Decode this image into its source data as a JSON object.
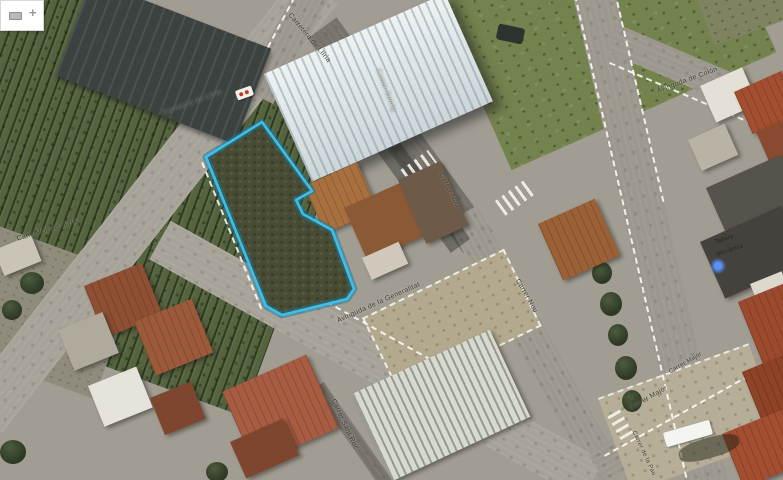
{
  "app": {
    "widget": {
      "zoom_in_label": "+"
    }
  },
  "map": {
    "view_type": "satellite-aerial",
    "parcel": {
      "outline_color": "#3cc0e8",
      "fill_color": "#484c35",
      "points": "206,157 262,122 312,191 296,200 303,214 332,230 354,289 347,299 282,315 266,306"
    },
    "street_labels": [
      {
        "text": "Carretera de Llíria"
      },
      {
        "text": "Carretera de Llíria"
      },
      {
        "text": "Camí Vell de Llíria"
      },
      {
        "text": "Carrer Enmig"
      },
      {
        "text": "Carrer Nou"
      },
      {
        "text": "Carrer Nou"
      },
      {
        "text": "Avinguda de la Generalitat"
      },
      {
        "text": "Avinguda de Colón"
      },
      {
        "text": "Carrer Major"
      },
      {
        "text": "Carrer Major"
      },
      {
        "text": "Carrer Sant Roc"
      },
      {
        "text": "Carrer de la Pau"
      }
    ],
    "place_labels": [
      {
        "text": "Tallers"
      },
      {
        "text": "Mecànics"
      }
    ],
    "colors": {
      "parcel_outline": "#3cc0e8",
      "road": "#9c988e",
      "orchard": "#55633f",
      "grass": "#74824e",
      "warehouse_roof": "#e7edef",
      "terracotta_roof": "#a85c41",
      "dark_industrial_roof": "#3c4240"
    }
  }
}
